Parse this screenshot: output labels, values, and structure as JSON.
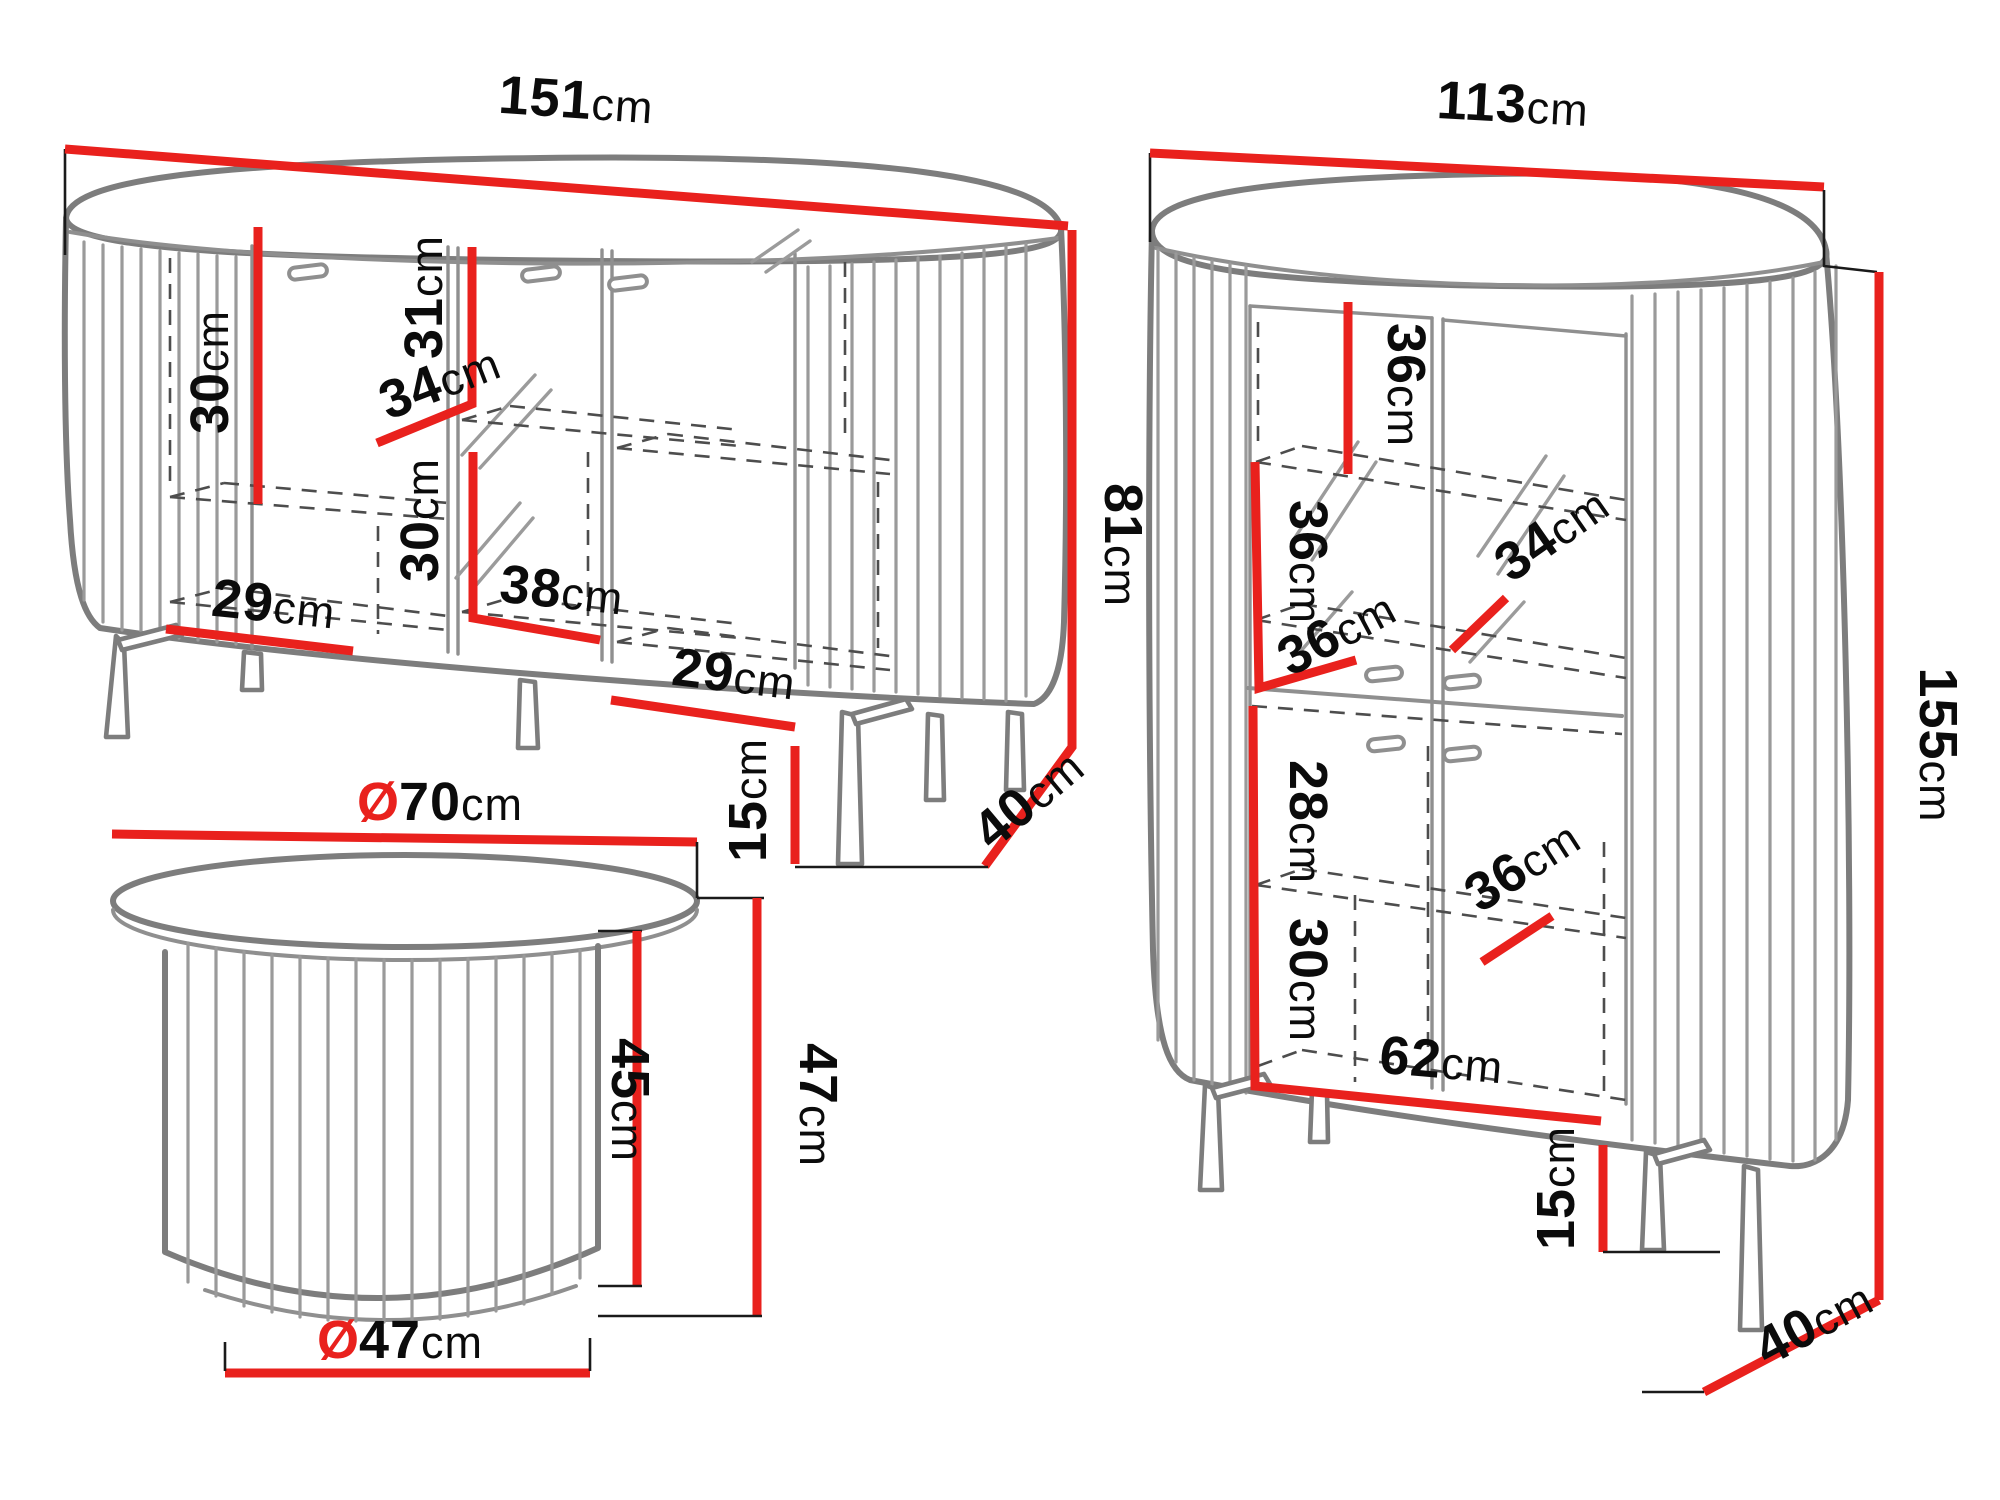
{
  "colors": {
    "dimension_red": "#e9211d",
    "furniture_gray": "#7d7d7d",
    "text_black": "#0b0b0b",
    "background": "#ffffff"
  },
  "furniture": {
    "sideboard": {
      "width": {
        "num": "151",
        "unit": "cm"
      },
      "height": {
        "num": "81",
        "unit": "cm"
      },
      "depth": {
        "num": "40",
        "unit": "cm"
      },
      "leg_height": {
        "num": "15",
        "unit": "cm"
      },
      "left_shelf_height": {
        "num": "30",
        "unit": "cm"
      },
      "door_inner_height": {
        "num": "31",
        "unit": "cm"
      },
      "shelf_depth": {
        "num": "34",
        "unit": "cm"
      },
      "lower_shelf_height": {
        "num": "30",
        "unit": "cm"
      },
      "center_width": {
        "num": "38",
        "unit": "cm"
      },
      "left_width": {
        "num": "29",
        "unit": "cm"
      },
      "right_width": {
        "num": "29",
        "unit": "cm"
      }
    },
    "cabinet": {
      "width": {
        "num": "113",
        "unit": "cm"
      },
      "height": {
        "num": "155",
        "unit": "cm"
      },
      "depth": {
        "num": "40",
        "unit": "cm"
      },
      "leg_height": {
        "num": "15",
        "unit": "cm"
      },
      "top_shelf_height": {
        "num": "36",
        "unit": "cm"
      },
      "top_shelf_depth": {
        "num": "34",
        "unit": "cm"
      },
      "middle_shelf_height": {
        "num": "36",
        "unit": "cm"
      },
      "middle_shelf_depth": {
        "num": "36",
        "unit": "cm"
      },
      "lower_section_height": {
        "num": "28",
        "unit": "cm"
      },
      "lower_shelf_depth": {
        "num": "36",
        "unit": "cm"
      },
      "bottom_shelf_height": {
        "num": "30",
        "unit": "cm"
      },
      "interior_width": {
        "num": "62",
        "unit": "cm"
      }
    },
    "coffee_table": {
      "top_diameter": {
        "sym": "Ø",
        "num": "70",
        "unit": "cm"
      },
      "base_diameter": {
        "sym": "Ø",
        "num": "47",
        "unit": "cm"
      },
      "total_height": {
        "num": "47",
        "unit": "cm"
      },
      "column_height": {
        "num": "45",
        "unit": "cm"
      }
    }
  }
}
